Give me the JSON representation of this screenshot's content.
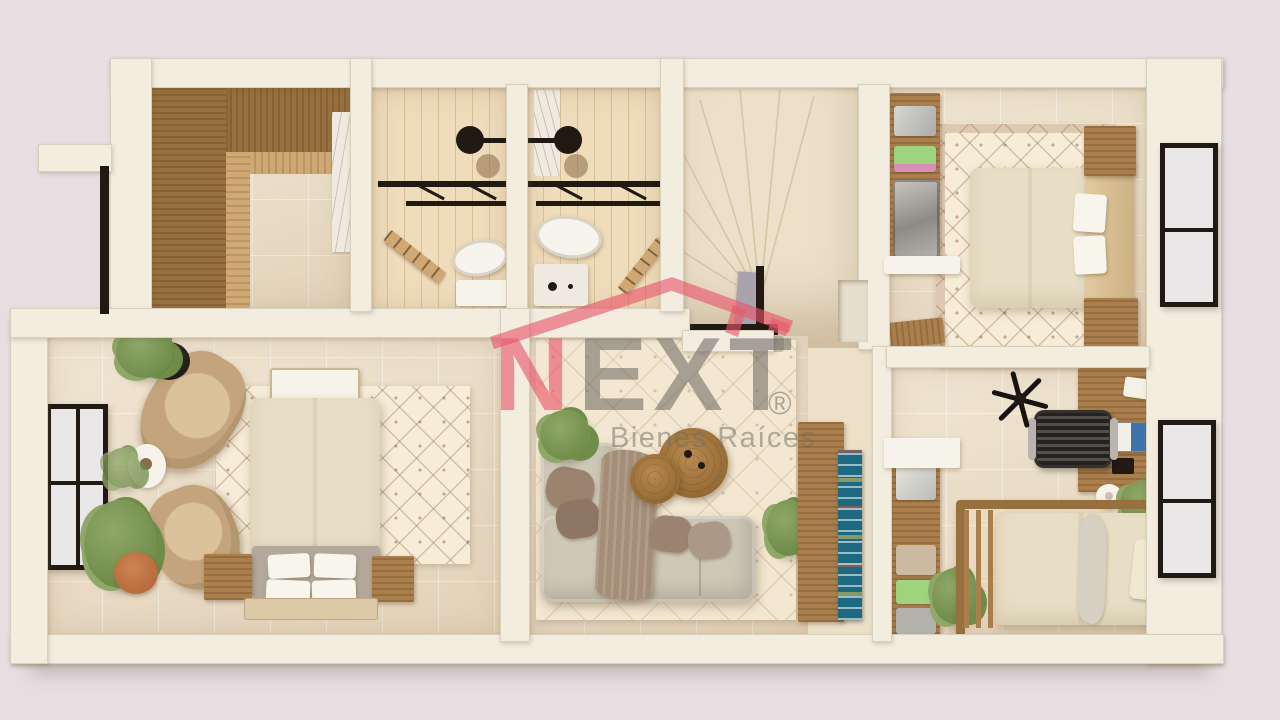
{
  "watermark": {
    "brand_initial": "N",
    "brand_rest": "EXT",
    "registered_mark": "®",
    "tagline": "Bienes Raíces"
  },
  "palette": {
    "bg": "#e6dfe2",
    "wall": "#f3ede0",
    "floor_tile": "#ebdcc3",
    "floor_warm": "#ece0c9",
    "floor_wood": "#eedcbb",
    "wood_dark": "#96703f",
    "wood_mid": "#ab7f4c",
    "wood_light": "#cfa873",
    "rug_cream": "#f6ecd8",
    "sofa_fabric": "#cfc8b7",
    "tan_chair": "#c3a47d",
    "bed_white": "#f3eee0",
    "bench_gray": "#b3a899",
    "plant": "#6f8c49",
    "plant_light": "#8fa768",
    "terracotta": "#b76b3e",
    "black_fixture": "#201a13",
    "glass": "#e9e7e8",
    "teal_shelf": "#1d6a80",
    "marble": "#efe9df",
    "logo_red": "#e8556b",
    "logo_gray": "#6e6b64"
  },
  "scene": {
    "type": "3d-floor-plan-top-down-render",
    "style": "beige-travertine-and-wood-real-estate-visualization",
    "rooms": [
      {
        "id": "walk-in-closet",
        "position": "top-left"
      },
      {
        "id": "bathroom-1",
        "position": "top-center-left"
      },
      {
        "id": "bathroom-2",
        "position": "top-center"
      },
      {
        "id": "stairwell",
        "position": "center-top"
      },
      {
        "id": "bedroom-2",
        "position": "top-right"
      },
      {
        "id": "master-bedroom",
        "position": "bottom-left"
      },
      {
        "id": "living-lounge",
        "position": "bottom-center"
      },
      {
        "id": "bedroom-3",
        "position": "bottom-right"
      }
    ]
  }
}
